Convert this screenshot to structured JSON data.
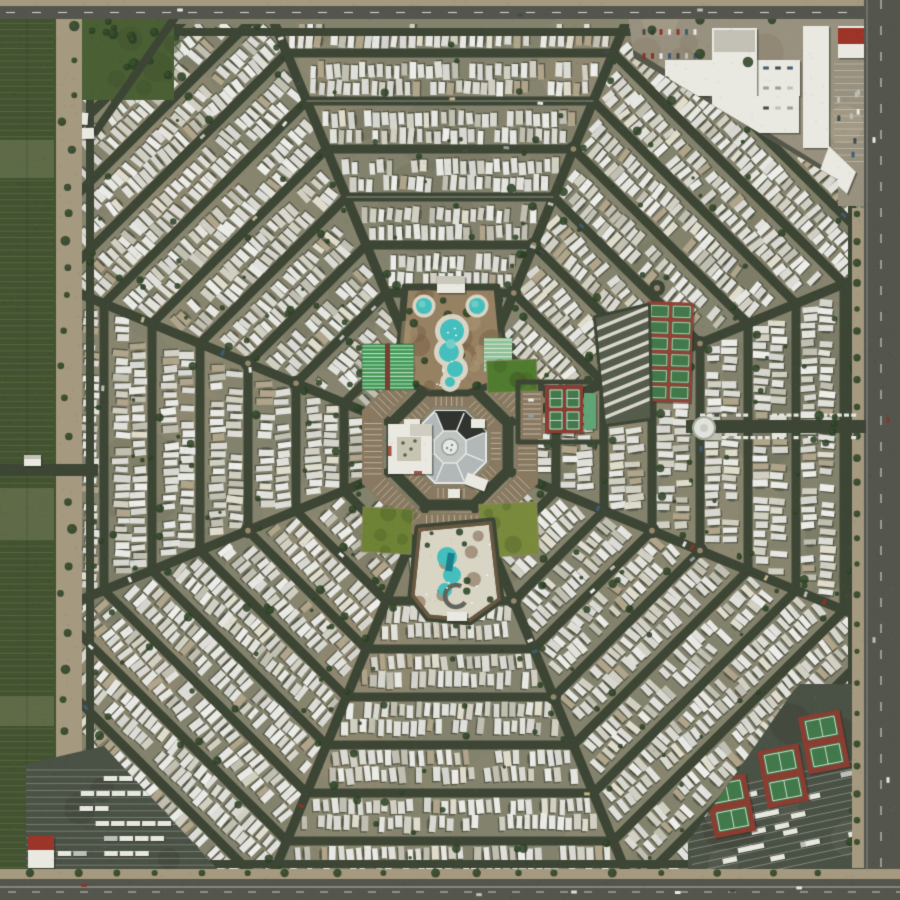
{
  "scene": {
    "type": "aerial-satellite-photo",
    "subject": "octagonal-spiderweb-trailer-park",
    "canvas": {
      "width": 900,
      "height": 900
    },
    "seed": 1337,
    "palette": {
      "ground": "#85836f",
      "ground_light": "#a29176",
      "ground_warm": "#99927b",
      "ground_dark": "#666a57",
      "street": "#3b4334",
      "trailer_shadow": "rgba(38,44,34,0.5)",
      "tree_dark": "#283c23",
      "tree_light": "#3c5a2e",
      "roof_gray": "#b7bcbe",
      "roof_dark": "#22241f",
      "roof_trim": "#eceff0",
      "parking_tan": "#8c7a62",
      "stripe_white": "#e9e5da",
      "pool_water": "#43c4c4",
      "pool_water_light": "#8adcd6",
      "pool_deck": "#e0dbcc",
      "planter_brown": "#7b5d45",
      "planter_tan": "#9a8263",
      "lawn_ne": "#4f7d2e",
      "lawn_sw": "#6f8433",
      "lawn_se": "#7b8c3c",
      "field_green": "#4a5e33",
      "sport_green": "#3f7a4a",
      "sport_red": "#8e3a30",
      "shuffle_green": "#3f9e58",
      "shuffle_pale": "#d8ecd8",
      "courts_pale_green": "#8fc79b",
      "teal_building": "#5fa878",
      "storage_bg": "#565b4c",
      "commercial_tan": "#9d9382",
      "building_white": "#f2f1ea",
      "red_roof": "#a03126",
      "asphalt_lot": "#494f44",
      "asphalt_road": "#53544d",
      "shoulder_tan": "#a99c82",
      "farm_green": "#41502f",
      "farm_row": "#5d7045",
      "car_colors": [
        "#f2f2ec",
        "#e8e8e2",
        "#c2c5c0",
        "#9aa0a2",
        "#42484a",
        "#8c3028",
        "#3f5a78",
        "#c9b98e"
      ]
    },
    "geometry": {
      "center_x": 450,
      "center_y": 447,
      "hub_apothem": 58,
      "ring_step": 48,
      "ring_count": 12,
      "spoke_angles_deg": [
        22.5,
        67.5,
        112.5,
        157.5,
        202.5,
        247.5,
        292.5,
        337.5
      ],
      "park_bounds": [
        82,
        24,
        860,
        872
      ],
      "trailer": {
        "len_min": 11.5,
        "len_max": 17,
        "wid_min": 5.2,
        "wid_max": 7.4,
        "spacing": 8.6
      }
    },
    "features": {
      "hub": {
        "building_apothem": 36,
        "inner_apothem": 16,
        "center_circle_r": 8,
        "parking_inner": [
          40,
          52
        ],
        "parking_outer": [
          66,
          88
        ],
        "west_wing": [
          398,
          429,
          26,
          40
        ],
        "west_wing2": [
          404,
          419,
          16,
          11
        ],
        "ne_building": [
          471,
          419,
          14,
          9
        ],
        "s_building": [
          448,
          489,
          12,
          9
        ],
        "red_kiosk": [
          422,
          429,
          7,
          5
        ]
      },
      "pool_north": {
        "poly": [
          [
            405,
            287
          ],
          [
            497,
            287
          ],
          [
            506,
            380
          ],
          [
            468,
            393
          ],
          [
            430,
            393
          ],
          [
            397,
            378
          ]
        ],
        "round_pools": [
          [
            424,
            306,
            8
          ],
          [
            477,
            306,
            8
          ]
        ],
        "main_pool": [
          [
            452,
            331,
            12
          ],
          [
            449,
            352,
            10
          ],
          [
            455,
            369,
            8
          ],
          [
            450,
            382,
            5
          ]
        ],
        "building": [
          437,
          276,
          28,
          17
        ]
      },
      "shuffleboard_west": {
        "rect": [
          362,
          344,
          52,
          46
        ]
      },
      "courts_nne": {
        "rect": [
          484,
          338,
          28,
          34
        ]
      },
      "lawn_ne": {
        "rect": [
          487,
          360,
          50,
          32
        ],
        "rot": -0.04
      },
      "lawn_sw": {
        "rect": [
          362,
          508,
          50,
          45
        ],
        "rot": 0.05
      },
      "lawn_se": {
        "rect": [
          480,
          503,
          58,
          53
        ],
        "rot": -0.05
      },
      "tennis_east": {
        "rect": [
          545,
          385,
          38,
          48
        ],
        "building": [
          584,
          393,
          12,
          36
        ],
        "parking": [
          521,
          391,
          22,
          48
        ]
      },
      "pickleball_ne": {
        "cx": 669,
        "cy": 352,
        "w": 46,
        "h": 100,
        "rot": 0.03,
        "rows": 6,
        "cols": 2
      },
      "storage_ne": {
        "poly": [
          [
            596,
            318
          ],
          [
            648,
            306
          ],
          [
            650,
            418
          ],
          [
            606,
            424
          ]
        ]
      },
      "roundabout_ne": {
        "x": 657,
        "y": 288,
        "r": 8
      },
      "pool_south": {
        "poly": [
          [
            418,
            528
          ],
          [
            492,
            521
          ],
          [
            501,
            600
          ],
          [
            470,
            622
          ],
          [
            428,
            618
          ],
          [
            411,
            596
          ]
        ],
        "pool": [
          [
            447,
            557,
            10
          ],
          [
            452,
            575,
            9
          ],
          [
            445,
            590,
            7
          ]
        ],
        "spa_ring": [
          456,
          596,
          11
        ],
        "building": [
          447,
          612,
          20,
          9
        ]
      },
      "rec_center_west": {
        "rect": [
          388,
          424,
          44,
          50
        ],
        "courtyard": [
          397,
          437,
          24,
          24
        ]
      },
      "entrance_east": {
        "road": [
          686,
          420,
          180,
          13
        ],
        "tank": [
          704,
          428,
          11
        ],
        "trees": [
          822,
          424
        ]
      },
      "entrance_west": {
        "road": [
          0,
          464,
          98,
          12
        ],
        "gatehouse": [
          24,
          455,
          17,
          11
        ]
      },
      "park_nw_green": {
        "rect": [
          22,
          18,
          152,
          82
        ],
        "road": [
          [
            176,
            16
          ],
          [
            94,
            134
          ]
        ],
        "buildings": [
          [
            52,
            96,
            26,
            13
          ],
          [
            58,
            112,
            30,
            12
          ],
          [
            70,
            128,
            24,
            11
          ]
        ]
      },
      "commercial_ne": {
        "poly": [
          [
            628,
            16
          ],
          [
            900,
            16
          ],
          [
            900,
            206
          ],
          [
            838,
            206
          ],
          [
            838,
            180
          ],
          [
            634,
            58
          ]
        ],
        "cross_building": [
          [
            665,
            60,
            135,
            36
          ],
          [
            712,
            28,
            45,
            105
          ],
          [
            757,
            96,
            42,
            37
          ]
        ],
        "gray_roof": [
          714,
          30,
          41,
          22
        ],
        "long_building": [
          803,
          26,
          26,
          122
        ],
        "long_building_angle": [
          [
            829,
            146
          ],
          [
            856,
            172
          ],
          [
            847,
            194
          ],
          [
            820,
            170
          ]
        ],
        "red_building": [
          838,
          26,
          30,
          32
        ],
        "access_road": [
          [
            630,
            52
          ],
          [
            836,
            178
          ]
        ]
      },
      "lot_se": {
        "poly": [
          [
            800,
            684
          ],
          [
            866,
            684
          ],
          [
            866,
            876
          ],
          [
            688,
            876
          ],
          [
            688,
            842
          ],
          [
            794,
            690
          ]
        ],
        "court_clusters": [
          [
            824,
            742
          ],
          [
            783,
            776
          ],
          [
            730,
            806
          ]
        ],
        "court_rot": -0.19,
        "rv_center": [
          778,
          812
        ]
      },
      "lot_sw": {
        "poly": [
          [
            26,
            764
          ],
          [
            104,
            746
          ],
          [
            222,
            874
          ],
          [
            26,
            874
          ]
        ],
        "red_building": [
          28,
          836,
          26,
          32
        ]
      },
      "farm_west": {
        "rect": [
          0,
          14,
          56,
          886
        ],
        "patches": [
          [
            0,
            140,
            54,
            38
          ],
          [
            0,
            488,
            54,
            52
          ],
          [
            0,
            696,
            54,
            30
          ]
        ]
      },
      "shoulder_west": {
        "rect": [
          56,
          14,
          26,
          886
        ]
      },
      "road_top": {
        "shoulder": [
          0,
          0,
          900,
          6
        ],
        "asphalt": [
          0,
          6,
          900,
          13
        ]
      },
      "road_right": {
        "asphalt": [
          864,
          0,
          36,
          900
        ],
        "shoulder": [
          852,
          208,
          12,
          660
        ]
      },
      "road_bottom": {
        "shoulder": [
          0,
          869,
          900,
          10
        ],
        "asphalt": [
          0,
          879,
          900,
          21
        ]
      }
    }
  }
}
